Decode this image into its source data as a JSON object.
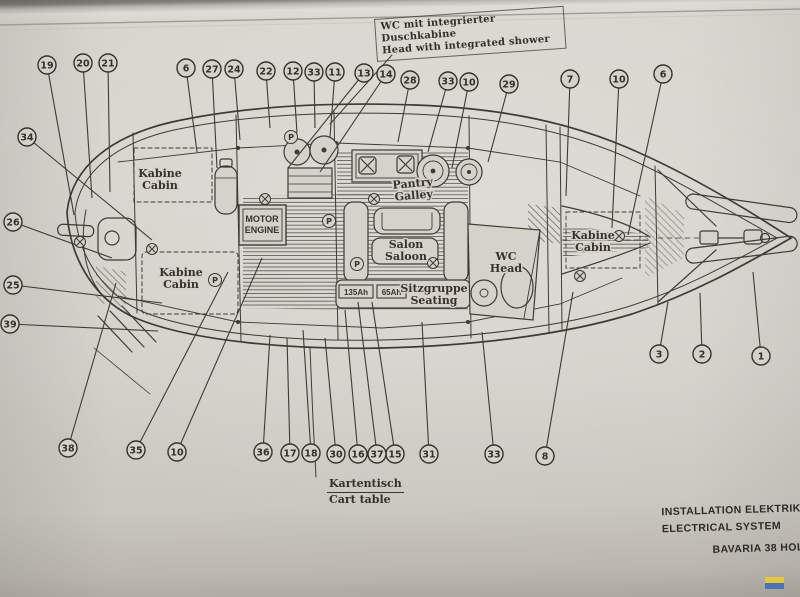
{
  "annotation": {
    "de": "WC mit integrierter Duschkabine",
    "en": "Head with integrated shower"
  },
  "chart_table": {
    "de": "Kartentisch",
    "en": "Cart table"
  },
  "title_block": {
    "de": "INSTALLATION  ELEKTRIK",
    "en": "ELECTRICAL  SYSTEM",
    "model": "BAVARIA  38  HOLIDAY"
  },
  "colors": {
    "paper": "#d5d2ca",
    "ink": "#3e3a34",
    "logo_yellow": "#e3c53e",
    "logo_blue": "#4a74b4"
  },
  "diagram": {
    "callouts": [
      {
        "n": "19",
        "x": 47,
        "y": 65,
        "tx": 74,
        "ty": 215
      },
      {
        "n": "20",
        "x": 83,
        "y": 63,
        "tx": 92,
        "ty": 198
      },
      {
        "n": "21",
        "x": 108,
        "y": 63,
        "tx": 110,
        "ty": 192
      },
      {
        "n": "6",
        "x": 186,
        "y": 68,
        "tx": 197,
        "ty": 152
      },
      {
        "n": "27",
        "x": 212,
        "y": 69,
        "tx": 217,
        "ty": 168
      },
      {
        "n": "24",
        "x": 234,
        "y": 69,
        "tx": 240,
        "ty": 140
      },
      {
        "n": "22",
        "x": 266,
        "y": 71,
        "tx": 270,
        "ty": 128
      },
      {
        "n": "12",
        "x": 293,
        "y": 71,
        "tx": 297,
        "ty": 133
      },
      {
        "n": "33",
        "x": 314,
        "y": 72,
        "tx": 315,
        "ty": 128
      },
      {
        "n": "11",
        "x": 335,
        "y": 72,
        "tx": 330,
        "ty": 137
      },
      {
        "n": "13",
        "x": 364,
        "y": 73,
        "tx": 288,
        "ty": 168
      },
      {
        "n": "14",
        "x": 386,
        "y": 74,
        "tx": 320,
        "ty": 172
      },
      {
        "n": "28",
        "x": 410,
        "y": 80,
        "tx": 398,
        "ty": 142
      },
      {
        "n": "33",
        "x": 448,
        "y": 81,
        "tx": 428,
        "ty": 152
      },
      {
        "n": "10",
        "x": 469,
        "y": 82,
        "tx": 452,
        "ty": 168
      },
      {
        "n": "29",
        "x": 509,
        "y": 84,
        "tx": 488,
        "ty": 162
      },
      {
        "n": "7",
        "x": 570,
        "y": 79,
        "tx": 566,
        "ty": 196
      },
      {
        "n": "10",
        "x": 619,
        "y": 79,
        "tx": 612,
        "ty": 228
      },
      {
        "n": "6",
        "x": 663,
        "y": 74,
        "tx": 628,
        "ty": 235
      },
      {
        "n": "34",
        "x": 27,
        "y": 137,
        "tx": 152,
        "ty": 240
      },
      {
        "n": "26",
        "x": 13,
        "y": 222,
        "tx": 112,
        "ty": 258
      },
      {
        "n": "25",
        "x": 13,
        "y": 285,
        "tx": 162,
        "ty": 303
      },
      {
        "n": "39",
        "x": 10,
        "y": 324,
        "tx": 158,
        "ty": 331
      },
      {
        "n": "38",
        "x": 68,
        "y": 448,
        "tx": 116,
        "ty": 283
      },
      {
        "n": "35",
        "x": 136,
        "y": 450,
        "tx": 228,
        "ty": 272
      },
      {
        "n": "10",
        "x": 177,
        "y": 452,
        "tx": 262,
        "ty": 258
      },
      {
        "n": "36",
        "x": 263,
        "y": 452,
        "tx": 270,
        "ty": 335
      },
      {
        "n": "17",
        "x": 290,
        "y": 453,
        "tx": 287,
        "ty": 338
      },
      {
        "n": "18",
        "x": 311,
        "y": 453,
        "tx": 303,
        "ty": 330
      },
      {
        "n": "30",
        "x": 336,
        "y": 454,
        "tx": 325,
        "ty": 338
      },
      {
        "n": "16",
        "x": 358,
        "y": 454,
        "tx": 345,
        "ty": 310
      },
      {
        "n": "37",
        "x": 377,
        "y": 454,
        "tx": 358,
        "ty": 302
      },
      {
        "n": "15",
        "x": 395,
        "y": 454,
        "tx": 372,
        "ty": 302
      },
      {
        "n": "31",
        "x": 429,
        "y": 454,
        "tx": 422,
        "ty": 322
      },
      {
        "n": "33",
        "x": 494,
        "y": 454,
        "tx": 482,
        "ty": 332
      },
      {
        "n": "8",
        "x": 545,
        "y": 456,
        "tx": 573,
        "ty": 292
      },
      {
        "n": "3",
        "x": 659,
        "y": 354,
        "tx": 668,
        "ty": 302
      },
      {
        "n": "2",
        "x": 702,
        "y": 354,
        "tx": 700,
        "ty": 293
      },
      {
        "n": "1",
        "x": 761,
        "y": 356,
        "tx": 753,
        "ty": 272
      }
    ],
    "rooms": [
      {
        "id": "cabin-aft-port",
        "line1": "Kabine",
        "line2": "Cabin",
        "x": 160,
        "y": 177
      },
      {
        "id": "cabin-aft-stbd",
        "line1": "Kabine",
        "line2": "Cabin",
        "x": 181,
        "y": 276
      },
      {
        "id": "cabin-fore",
        "line1": "Kabine",
        "line2": "Cabin",
        "x": 593,
        "y": 239
      },
      {
        "id": "galley",
        "line1": "Pantry",
        "line2": "Galley",
        "x": 413,
        "y": 187,
        "rot": -5
      },
      {
        "id": "saloon",
        "line1": "Salon",
        "line2": "Saloon",
        "x": 406,
        "y": 248
      },
      {
        "id": "head",
        "line1": "WC",
        "line2": "Head",
        "x": 506,
        "y": 260
      },
      {
        "id": "seating",
        "line1": "Sitzgruppe",
        "line2": "Seating",
        "x": 434,
        "y": 292
      },
      {
        "id": "engine",
        "line1": "MOTOR",
        "line2": "ENGINE",
        "x": 262,
        "y": 222,
        "boxed": true
      }
    ],
    "batteries": [
      {
        "label": "135Ah",
        "x": 339,
        "y": 285,
        "w": 34,
        "h": 13
      },
      {
        "label": "65Ah",
        "x": 377,
        "y": 285,
        "w": 29,
        "h": 13
      }
    ],
    "symbols": {
      "circled_x": [
        [
          265,
          199
        ],
        [
          374,
          199
        ],
        [
          80,
          242
        ],
        [
          619,
          236
        ],
        [
          580,
          276
        ],
        [
          433,
          263
        ],
        [
          152,
          249
        ]
      ],
      "circled_p": [
        [
          291,
          137
        ],
        [
          329,
          221
        ],
        [
          215,
          280
        ],
        [
          357,
          264
        ]
      ]
    }
  }
}
